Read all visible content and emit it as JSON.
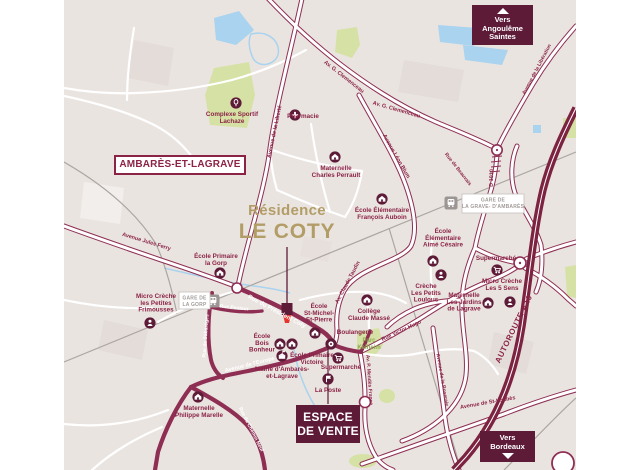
{
  "colors": {
    "wine": "#8b2346",
    "casing": "#8e2e53",
    "autoroute": "#7d2342",
    "badge": "#5e1b38",
    "gold": "#b39d66",
    "water": "#a9d3ee",
    "green": "#d6e2a5",
    "green_text": "#8fa851",
    "bg": "#eae4e1",
    "rail": "#aca6a2",
    "station_gray": "#9b9593",
    "station_text": "#a29c99",
    "pin_red": "#e8332b",
    "block": "#e3dcd8"
  },
  "residence": {
    "line1": "Résidence",
    "line2": "LE COTY"
  },
  "city_label": "AMBARÈS-ET-LAGRAVE",
  "sales_office": {
    "line1": "ESPACE",
    "line2": "DE VENTE"
  },
  "badges": {
    "north": {
      "line1": "Vers Angoulême",
      "line2": "Saintes"
    },
    "south": {
      "line1": "Vers",
      "line2": "Bordeaux"
    }
  },
  "park": {
    "line1": "Parc",
    "line2": "Kelheim"
  },
  "stations": [
    {
      "id": "gare-de-la-gorp",
      "lines": [
        "GARE DE",
        "LA GORP"
      ],
      "icon_x": 149,
      "icon_y": 301,
      "box": [
        115,
        292,
        31,
        17
      ]
    },
    {
      "id": "gare-de-la-grave-d-ambares",
      "lines": [
        "GARE DE",
        "LA GRAVE- D'AMBARÈS"
      ],
      "icon_x": 387,
      "icon_y": 203,
      "box": [
        398,
        194,
        62,
        19
      ]
    }
  ],
  "pois": [
    {
      "id": "complexe-sportif-lachaze",
      "icon": "sport",
      "x": 172,
      "y": 103,
      "label": [
        "Complexe Sportif",
        "Lachaze"
      ],
      "lx": 168,
      "ly": 116
    },
    {
      "id": "pharmacie",
      "icon": "cross",
      "x": 231,
      "y": 115,
      "label": [
        "Pharmacie"
      ],
      "lx": 239,
      "ly": 118,
      "anchor": "start"
    },
    {
      "id": "maternelle-charles-perrault",
      "icon": "school",
      "x": 271,
      "y": 157,
      "label": [
        "Maternelle",
        "Charles Perrault"
      ],
      "lx": 272,
      "ly": 170
    },
    {
      "id": "ecole-elementaire-francois-auboin",
      "icon": "school",
      "x": 318,
      "y": 199,
      "label": [
        "École Élémentaire",
        "François Auboin"
      ],
      "lx": 318,
      "ly": 212
    },
    {
      "id": "ecole-elementaire-aime-cesaire",
      "icon": "school",
      "x": 369,
      "y": 261,
      "label": [
        "École",
        "Élémentaire",
        "Aimé Césaire"
      ],
      "lx": 379,
      "ly": 233
    },
    {
      "id": "creche-les-petits-loulous",
      "icon": "creche",
      "x": 377,
      "y": 275,
      "label": [
        "Crèche",
        "Les Petits",
        "Loulous"
      ],
      "lx": 362,
      "ly": 288
    },
    {
      "id": "supermarche-est",
      "icon": "cart",
      "x": 433,
      "y": 270,
      "label": [
        "Supermarché"
      ],
      "lx": 432,
      "ly": 260
    },
    {
      "id": "micro-creche-les-5-sens",
      "icon": "creche",
      "x": 446,
      "y": 302,
      "label": [
        "Micro Crèche",
        "Les 5 Sens"
      ],
      "lx": 438,
      "ly": 283
    },
    {
      "id": "maternelle-les-jardins-de-lagrave",
      "icon": "school",
      "x": 424,
      "y": 303,
      "label": [
        "Maternelle",
        "Les Jardins",
        "de Lagrave"
      ],
      "lx": 400,
      "ly": 297
    },
    {
      "id": "micro-creche-les-petites-frimousses",
      "icon": "creche",
      "x": 86,
      "y": 323,
      "label": [
        "Micro Crèche",
        "les Petites",
        "Frimousses"
      ],
      "lx": 92,
      "ly": 298
    },
    {
      "id": "ecole-primaire-la-gorp",
      "icon": "school",
      "x": 156,
      "y": 273,
      "label": [
        "École Primaire",
        "la Gorp"
      ],
      "lx": 152,
      "ly": 258
    },
    {
      "id": "ecole-st-michel-st-pierre",
      "icon": "school",
      "x": 251,
      "y": 333,
      "label": [
        "École",
        "St-Michel-",
        "St-Pierre"
      ],
      "lx": 255,
      "ly": 308
    },
    {
      "id": "college-claude-masse",
      "icon": "school",
      "x": 303,
      "y": 300,
      "label": [
        "Collège",
        "Claude Massé"
      ],
      "lx": 305,
      "ly": 313
    },
    {
      "id": "boulangerie",
      "icon": "bread",
      "x": 267,
      "y": 344,
      "label": [
        "Boulangerie"
      ],
      "lx": 291,
      "ly": 334
    },
    {
      "id": "ecole-bois-bonheur",
      "icon": "school",
      "x": 216,
      "y": 344,
      "label": [
        "École",
        "Bois",
        "Bonheur"
      ],
      "lx": 198,
      "ly": 338
    },
    {
      "id": "ecole-primaire-victoire",
      "icon": "school",
      "x": 228,
      "y": 344,
      "label": [
        "École Primaire",
        "Victoire"
      ],
      "lx": 248,
      "ly": 357
    },
    {
      "id": "supermarche-centre",
      "icon": "cart",
      "x": 274,
      "y": 358,
      "label": [
        "Supermarché"
      ],
      "lx": 277,
      "ly": 369
    },
    {
      "id": "mairie-ambares-et-lagrave",
      "icon": "hall",
      "x": 218,
      "y": 356,
      "label": [
        "Mairie d'Ambarès-",
        "et-Lagrave"
      ],
      "lx": 218,
      "ly": 371
    },
    {
      "id": "la-poste",
      "icon": "flag",
      "x": 264,
      "y": 379,
      "label": [
        "La Poste"
      ],
      "lx": 264,
      "ly": 392
    },
    {
      "id": "maternelle-philippe-marelle",
      "icon": "school",
      "x": 134,
      "y": 397,
      "label": [
        "Maternelle",
        "Philippe Marelle"
      ],
      "lx": 135,
      "ly": 410
    }
  ],
  "road_labels": [
    {
      "id": "avenue-de-la-liberte",
      "text": "Avenue de la Liberté",
      "x": 212,
      "y": 132,
      "rot": -78,
      "size": 5.5
    },
    {
      "id": "av-g-clemenceau-1",
      "text": "Av. G. Clemenceau",
      "x": 279,
      "y": 78,
      "rot": 38,
      "size": 5.5
    },
    {
      "id": "av-g-clemenceau-2",
      "text": "Av. G. Clemenceau",
      "x": 332,
      "y": 111,
      "rot": 16,
      "size": 5.5
    },
    {
      "id": "avenue-leon-blum",
      "text": "Avenue Léon Blum",
      "x": 331,
      "y": 157,
      "rot": 60,
      "size": 5.5
    },
    {
      "id": "rue-de-beauvais",
      "text": "Rue de Beauvais",
      "x": 393,
      "y": 170,
      "rot": 52,
      "size": 5
    },
    {
      "id": "d-1010",
      "text": "D 1010",
      "x": 429,
      "y": 178,
      "rot": -88,
      "size": 5.5
    },
    {
      "id": "avenue-de-la-liberation",
      "text": "Avenue de la Libération",
      "x": 474,
      "y": 70,
      "rot": -62,
      "size": 5
    },
    {
      "id": "avenue-jules-ferry",
      "text": "Avenue Jules Ferry",
      "x": 82,
      "y": 243,
      "rot": 17,
      "size": 5.5
    },
    {
      "id": "rue-du-president-coty",
      "text": "Rue du Président Coty",
      "x": 212,
      "y": 313,
      "rot": 28,
      "size": 6,
      "color": "white"
    },
    {
      "id": "rue-pasteur",
      "text": "Rue Pasteur",
      "x": 170,
      "y": 309,
      "rot": 6,
      "size": 5,
      "color": "white"
    },
    {
      "id": "avenue-de-l-europe",
      "text": "Avenue de l'Europe",
      "x": 186,
      "y": 366,
      "rot": -14,
      "size": 5.5,
      "color": "white"
    },
    {
      "id": "rue-de-sabareges",
      "text": "Rue de Sabarèges",
      "x": 143,
      "y": 336,
      "rot": -86,
      "size": 5,
      "color": "white"
    },
    {
      "id": "rue-du-chemin-neuf",
      "text": "Rue du Chemin Neuf",
      "x": 186,
      "y": 430,
      "rot": 63,
      "size": 5,
      "color": "white"
    },
    {
      "id": "rue-victor-hugo",
      "text": "Rue Victor Hugo",
      "x": 338,
      "y": 332,
      "rot": -25,
      "size": 5.5
    },
    {
      "id": "av-claude-taudin",
      "text": "Av. Claude Taudin",
      "x": 285,
      "y": 283,
      "rot": -62,
      "size": 5.5
    },
    {
      "id": "av-p-mendes-france",
      "text": "Av. P. Mendès France",
      "x": 304,
      "y": 380,
      "rot": 86,
      "size": 5
    },
    {
      "id": "avenue-de-st-loubes",
      "text": "Avenue de St-Loubès",
      "x": 424,
      "y": 404,
      "rot": -10,
      "size": 5.5
    },
    {
      "id": "avenue-de-la-roseraie",
      "text": "Avenue de la Roseraie",
      "x": 377,
      "y": 380,
      "rot": 80,
      "size": 5
    },
    {
      "id": "autoroute-a10",
      "text": "AUTOROUTE A10",
      "x": 452,
      "y": 330,
      "rot": -64,
      "size": 8,
      "hwy": true
    }
  ]
}
